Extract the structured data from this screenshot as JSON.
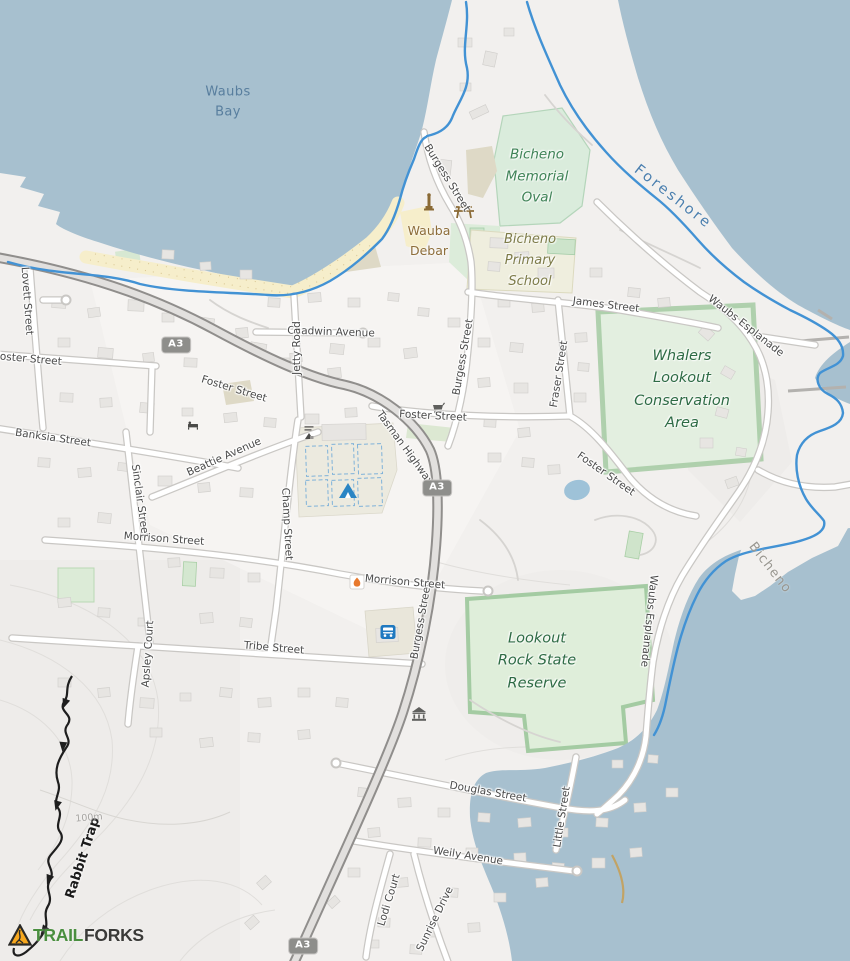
{
  "map_labels": {
    "water": {
      "waubs_bay": "Waubs Bay",
      "foreshore": "Foreshore"
    },
    "locality": {
      "bicheno": "Bicheno"
    },
    "areas": {
      "memorial_oval": "Bicheno Memorial Oval",
      "primary_school": "Bicheno Primary School",
      "whalers": "Whalers Lookout Conservation Area",
      "lookout_rock": "Lookout Rock State Reserve"
    },
    "poi": {
      "wauba_debar": "Wauba Debar"
    },
    "trail": {
      "rabbit_trap": "Rabbit Trap"
    },
    "contour": {
      "c100": "100m"
    },
    "shield": {
      "a3": "A3"
    },
    "streets": {
      "burgess_n": "Burgess Street",
      "burgess_mid": "Burgess Street",
      "burgess_s": "Burgess Street",
      "foster_w": "Foster Street",
      "foster_hwy": "Foster Street",
      "foster_c": "Foster Street",
      "foster_e": "Foster Street",
      "tasman_hwy": "Tasman Highway",
      "tasman_hwy_w": "Tasman Highway",
      "james": "James Street",
      "chadwin": "Chadwin Avenue",
      "jetty": "Jetty Road",
      "lovett": "Lovett Street",
      "banksia": "Banksia Street",
      "beattie": "Beattie Avenue",
      "sinclair": "Sinclair Street",
      "morrison_w": "Morrison Street",
      "morrison_e": "Morrison Street",
      "champ": "Champ Street",
      "apsley": "Apsley Court",
      "tribe": "Tribe Street",
      "waubs_esp_n": "Waubs Esplanade",
      "waubs_esp_s": "Waubs Esplanade",
      "fraser": "Fraser Street",
      "douglas": "Douglas Street",
      "little": "Little Street",
      "weily": "Weily Avenue",
      "lodi": "Lodi Court",
      "sunrise": "Sunrise Drive"
    }
  },
  "logo": {
    "trail": "TRAIL",
    "forks": "FORKS"
  },
  "icons": {
    "camping-icon": "tent",
    "bus-stop-icon": "bus",
    "picnic-table-icon": "picnic table",
    "monument-icon": "obelisk",
    "fire-pit-icon": "flame",
    "museum-icon": "columned building",
    "supermarket-icon": "shopping cart",
    "lodging-icon": "bed",
    "amenity-icon": "information bars"
  },
  "colors": {
    "water": "#a7c0cf",
    "land": "#f2f0ee",
    "park_fill": "#dfeeda",
    "park_border": "#9cc69b",
    "school_fill": "#efeede",
    "beach": "#f6eecb",
    "road_fill": "#ffffff",
    "road_casing": "#c9c7c4",
    "highway_fill": "#e2e0de",
    "highway_casing": "#908e8c",
    "foreshore_blue": "#4292d4",
    "trail_black": "#1e1e1e",
    "shield_bg": "#8e8e8b",
    "logo_yellow": "#f7a81f",
    "logo_green": "#4a8f3f",
    "logo_dark": "#3a3a38"
  }
}
